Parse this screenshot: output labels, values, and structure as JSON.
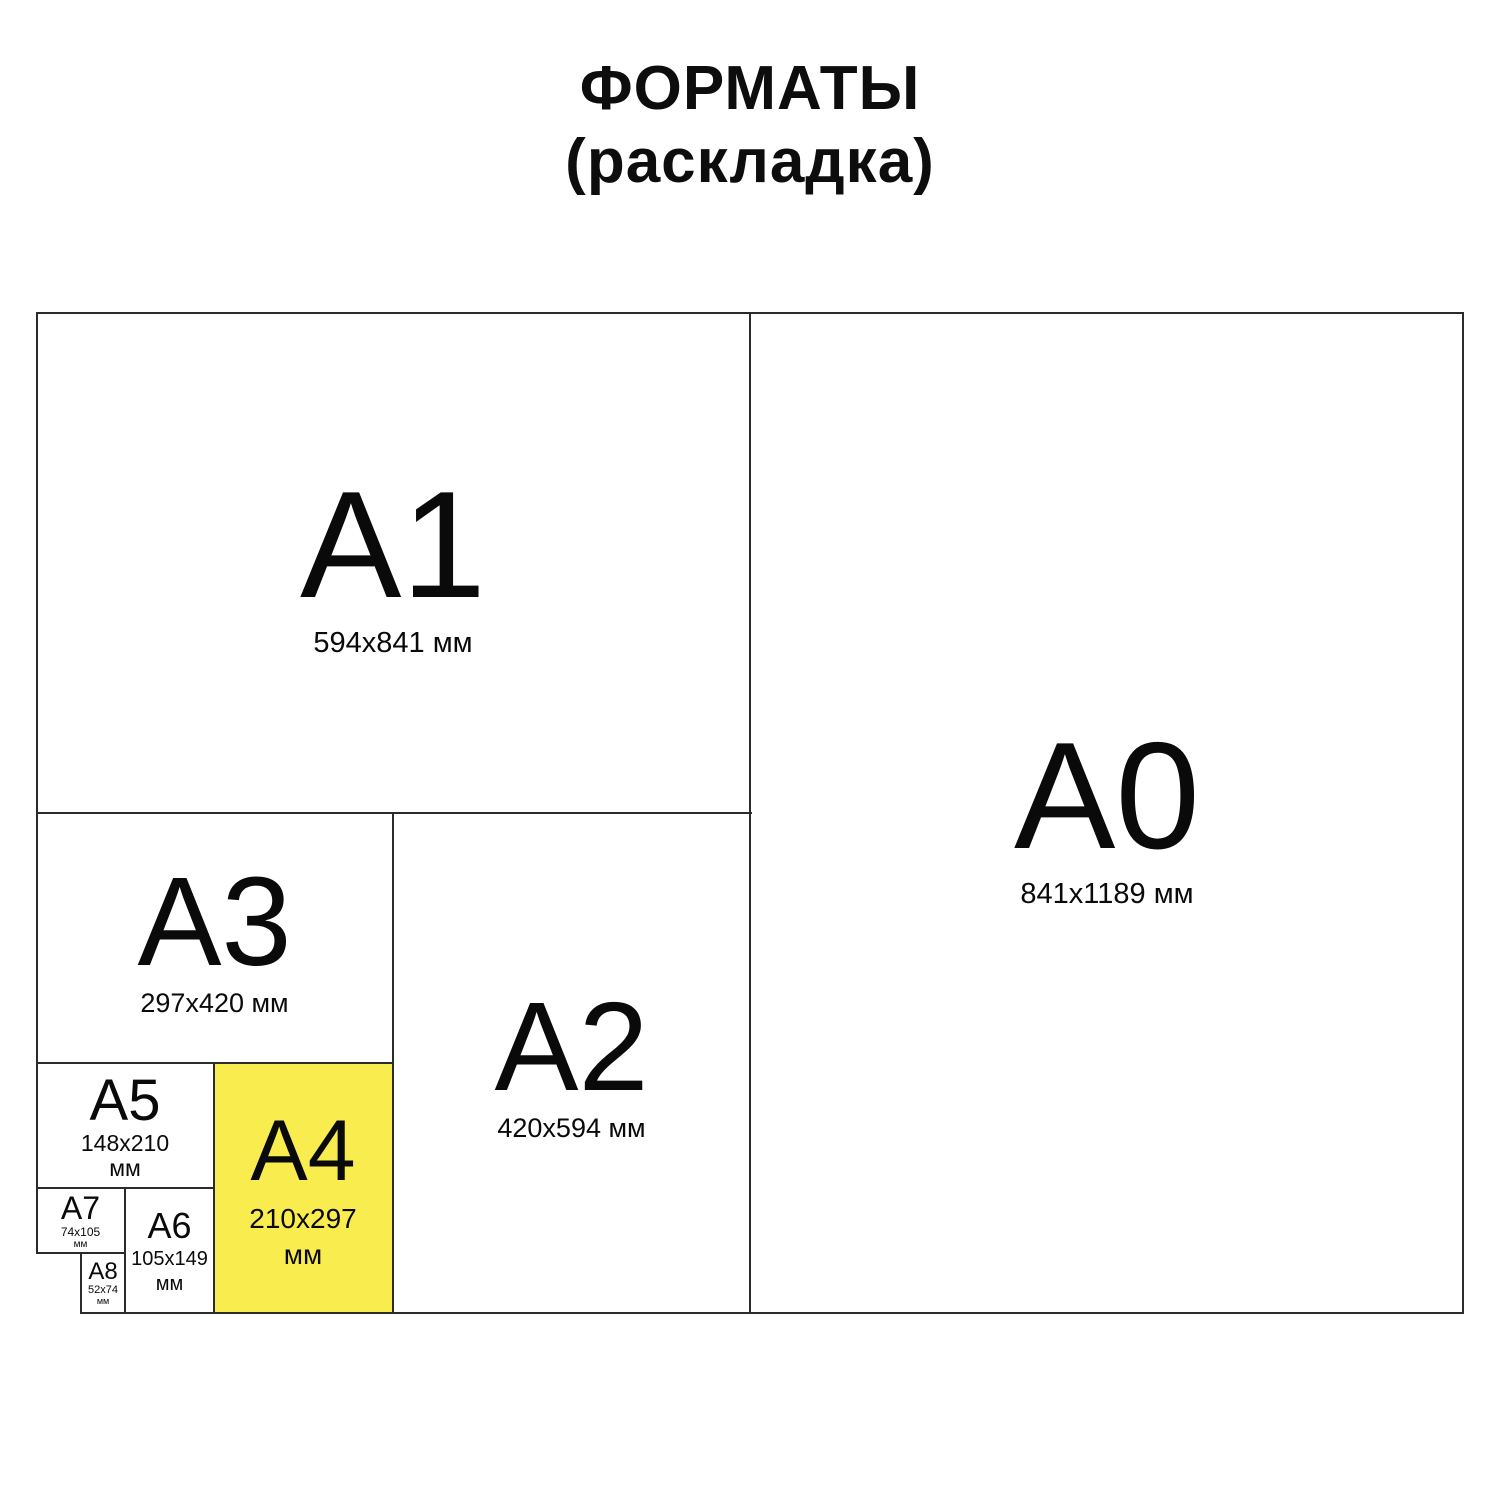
{
  "title": {
    "line1": "ФОРМАТЫ",
    "line2": "(раскладка)"
  },
  "colors": {
    "highlight_fill": "#F8EC4F",
    "line": "#2B2B2B",
    "text": "#0A0A0A",
    "background": "#FFFFFF"
  },
  "formats": {
    "a0": {
      "label": "A0",
      "lines": [
        "841x1189 мм"
      ],
      "highlighted": false
    },
    "a1": {
      "label": "A1",
      "lines": [
        "594x841 мм"
      ],
      "highlighted": false
    },
    "a2": {
      "label": "A2",
      "lines": [
        "420x594 мм"
      ],
      "highlighted": false
    },
    "a3": {
      "label": "A3",
      "lines": [
        "297x420 мм"
      ],
      "highlighted": false
    },
    "a4": {
      "label": "A4",
      "lines": [
        "210x297",
        "мм"
      ],
      "highlighted": true
    },
    "a5": {
      "label": "A5",
      "lines": [
        "148x210",
        "мм"
      ],
      "highlighted": false
    },
    "a6": {
      "label": "A6",
      "lines": [
        "105x149",
        "мм"
      ],
      "highlighted": false
    },
    "a7": {
      "label": "A7",
      "lines": [
        "74x105",
        "мм"
      ],
      "highlighted": false
    },
    "a8": {
      "label": "A8",
      "lines": [
        "52x74",
        "мм"
      ],
      "highlighted": false
    }
  }
}
